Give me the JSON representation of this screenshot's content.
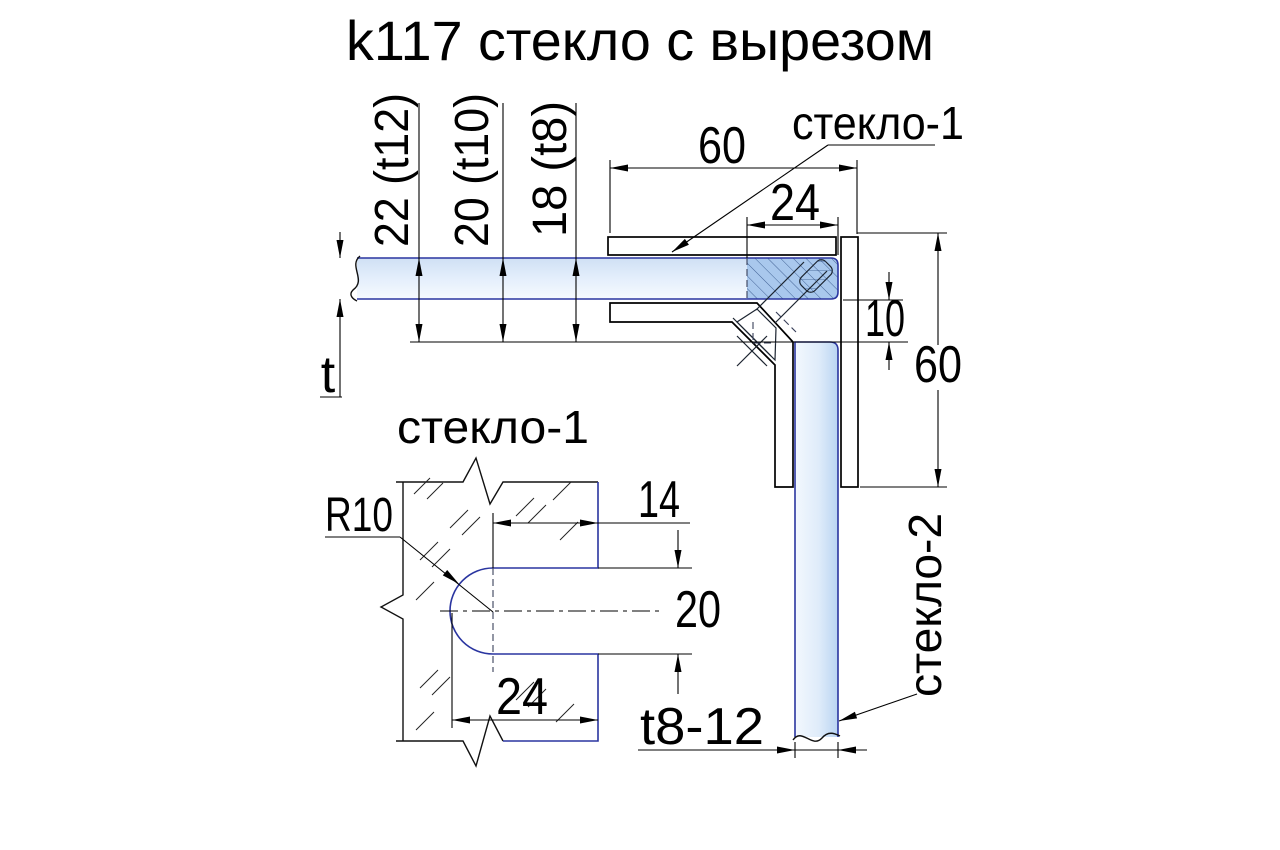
{
  "title": "k117 стекло с вырезом",
  "main_view": {
    "glass1_label": "стекло-1",
    "glass2_label": "стекло-2",
    "thickness_options": [
      {
        "label": "22 (t12)"
      },
      {
        "label": "20 (t10)"
      },
      {
        "label": "18 (t8)"
      }
    ],
    "dim_top_width": "60",
    "dim_notch_width": "24",
    "dim_gap": "10",
    "dim_side_height": "60",
    "thickness_symbol": "t",
    "glass2_thickness": "t8-12"
  },
  "detail_view": {
    "label": "стекло-1",
    "dim_radius": "R10",
    "dim_flat_width": "14",
    "dim_cutout_height": "20",
    "dim_cutout_depth": "24"
  },
  "colors": {
    "line": "#000000",
    "glass_outline": "#2a35a0",
    "glass_fill": "#d9e7f8",
    "glass_fill_clamped": "#a9c8ed",
    "background": "#ffffff"
  }
}
